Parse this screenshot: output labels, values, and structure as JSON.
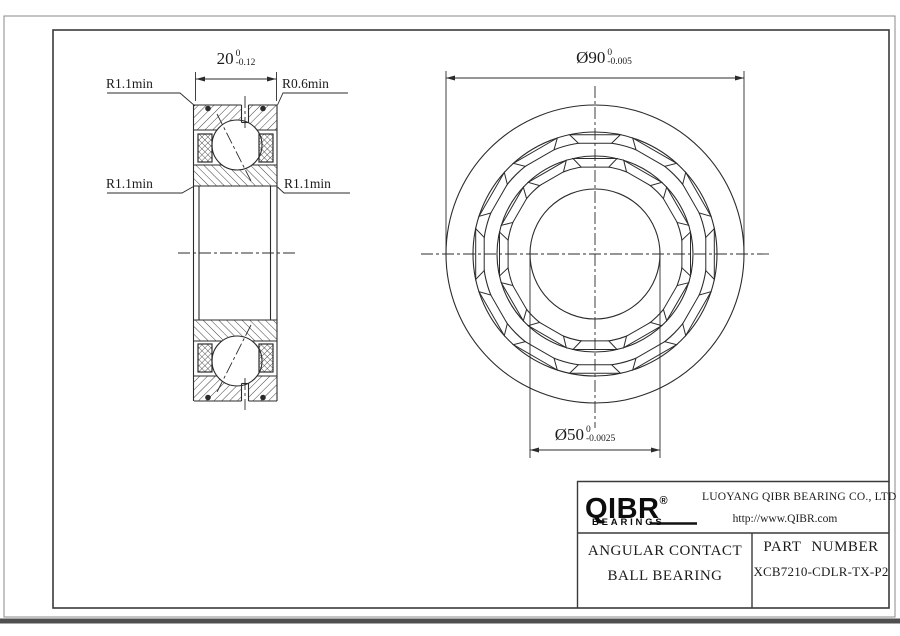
{
  "drawing": {
    "dimensions": {
      "width": {
        "value": "20",
        "tol_upper": "0",
        "tol_lower": "-0.12"
      },
      "outer_diameter": {
        "value": "Ø90",
        "tol_upper": "0",
        "tol_lower": "-0.005"
      },
      "bore_diameter": {
        "value": "Ø50",
        "tol_upper": "0",
        "tol_lower": "-0.0025"
      }
    },
    "radius_labels": {
      "top_left": "R1.1min",
      "top_right": "R0.6min",
      "mid_left": "R1.1min",
      "mid_right": "R1.1min"
    }
  },
  "title_block": {
    "logo_text": "QIBR",
    "logo_registered": "®",
    "logo_subtext": "BEARINGS",
    "company_name": "LUOYANG QIBR BEARING CO., LTD",
    "website": "http://www.QIBR.com",
    "product_type_line1": "ANGULAR CONTACT",
    "product_type_line2": "BALL BEARING",
    "part_number_label": "PART NUMBER",
    "part_number": "XCB7210-CDLR-TX-P2"
  },
  "colors": {
    "line": "#2b2b2b",
    "frame": "#3a3a3a",
    "background": "#ffffff"
  }
}
